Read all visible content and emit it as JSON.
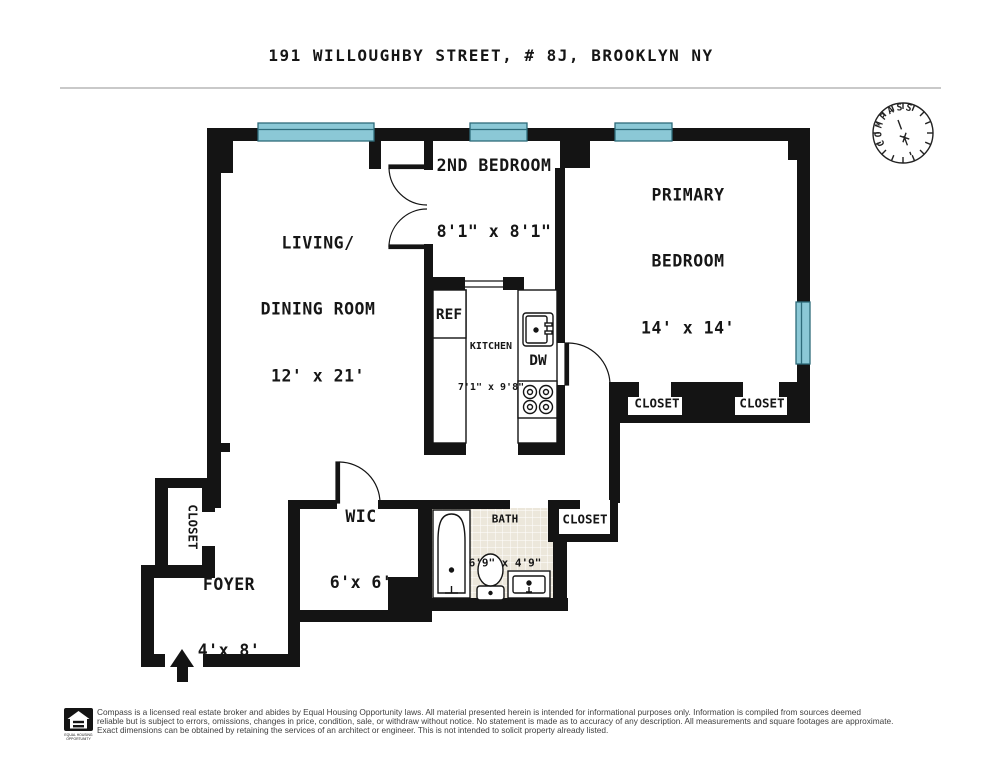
{
  "title": "191 WILLOUGHBY STREET, # 8J, BROOKLYN NY",
  "compass": {
    "label": "COMPASS"
  },
  "rooms": {
    "living": {
      "line1": "LIVING/",
      "line2": "DINING ROOM",
      "dims": "12' x 21'"
    },
    "second_bedroom": {
      "name": "2ND BEDROOM",
      "dims": "8'1\" x 8'1\""
    },
    "primary_bedroom": {
      "line1": "PRIMARY",
      "line2": "BEDROOM",
      "dims": "14' x 14'"
    },
    "kitchen": {
      "name": "KITCHEN",
      "dims": "7'1\" x 9'8\""
    },
    "wic": {
      "name": "WIC",
      "dims": "6'x 6'"
    },
    "bath": {
      "name": "BATH",
      "dims": "6'9\" x 4'9\""
    },
    "foyer": {
      "name": "FOYER",
      "dims": "4'x 8'"
    },
    "closet_primary_1": "CLOSET",
    "closet_primary_2": "CLOSET",
    "closet_hall": "CLOSET",
    "closet_entry": "CLOSET"
  },
  "appliances": {
    "ref": "REF",
    "dw": "DW"
  },
  "colors": {
    "wall": "#141414",
    "window_fill": "#8bc8d6",
    "window_stroke": "#2e6b7a",
    "tile": "#ece7db",
    "divider": "#c9c9c9"
  },
  "footer": {
    "eho_line1": "EQUAL HOUSING",
    "eho_line2": "OPPORTUNITY",
    "line1": "Compass is a licensed real estate broker and abides by Equal Housing Opportunity laws. All material presented herein is intended for informational purposes only. Information is compiled from sources deemed",
    "line2": "reliable but is subject to errors, omissions, changes in price, condition, sale, or withdraw without notice. No statement is made as to accuracy of any description. All measurements and square footages are approximate.",
    "line3": "Exact dimensions can be obtained by retaining the services of an architect or engineer. This is not intended to solicit property already listed."
  }
}
